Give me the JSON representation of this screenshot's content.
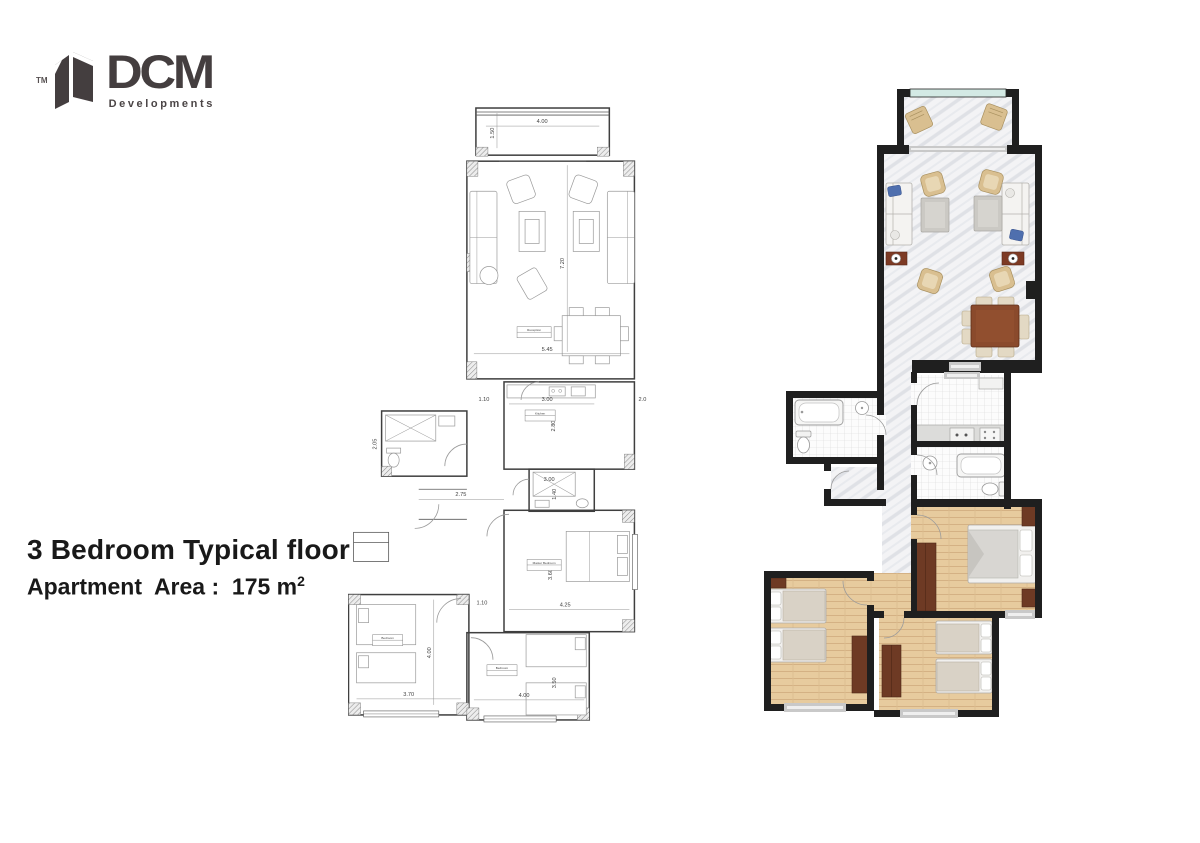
{
  "logo": {
    "tm": "TM",
    "name": "DCM",
    "subtitle": "Developments"
  },
  "title_block": {
    "title": "3 Bedroom Typical floor",
    "area_label": "Apartment  Area :  175 m",
    "area_exponent": "2"
  },
  "bw_plan": {
    "dims": {
      "balcony_w": "4.00",
      "balcony_d": "1.50",
      "living_w": "5.45",
      "living_h": "7.20",
      "hall1": "1.10",
      "kitchen_w": "3.00",
      "kitchen_d": "2.80",
      "kitchen_r": "2.0",
      "bath1_d": "2.05",
      "corridor": "2.75",
      "bath2_w": "3.00",
      "bath2_d": "1.40",
      "hall2": "1.10",
      "bed1_w": "3.70",
      "bed1_h": "4.00",
      "master_w": "4.25",
      "master_h": "3.60",
      "bed3_w": "4.00",
      "bed3_h": "3.50"
    },
    "tags": {
      "reception": "Reception",
      "kitchen": "Kitchen",
      "master": "Master Bedroom",
      "bedroom1": "Bedroom",
      "bedroom3": "Bedroom"
    }
  },
  "palette": {
    "wall": "#1f1f1f",
    "blueprint_line": "#3f3f3f",
    "marble_floor": "#f3f3f5",
    "tile_floor": "#fcfcfc",
    "wood_floor": "#e7cb9e",
    "furniture_brown": "#6e3a24",
    "dining_table_brown": "#8a4a2c",
    "pillow_blue": "#4f6fae",
    "wicker_tan": "#d9bf90",
    "glass_teal": "#d3e9e4",
    "logo_gray": "#443e3f"
  }
}
